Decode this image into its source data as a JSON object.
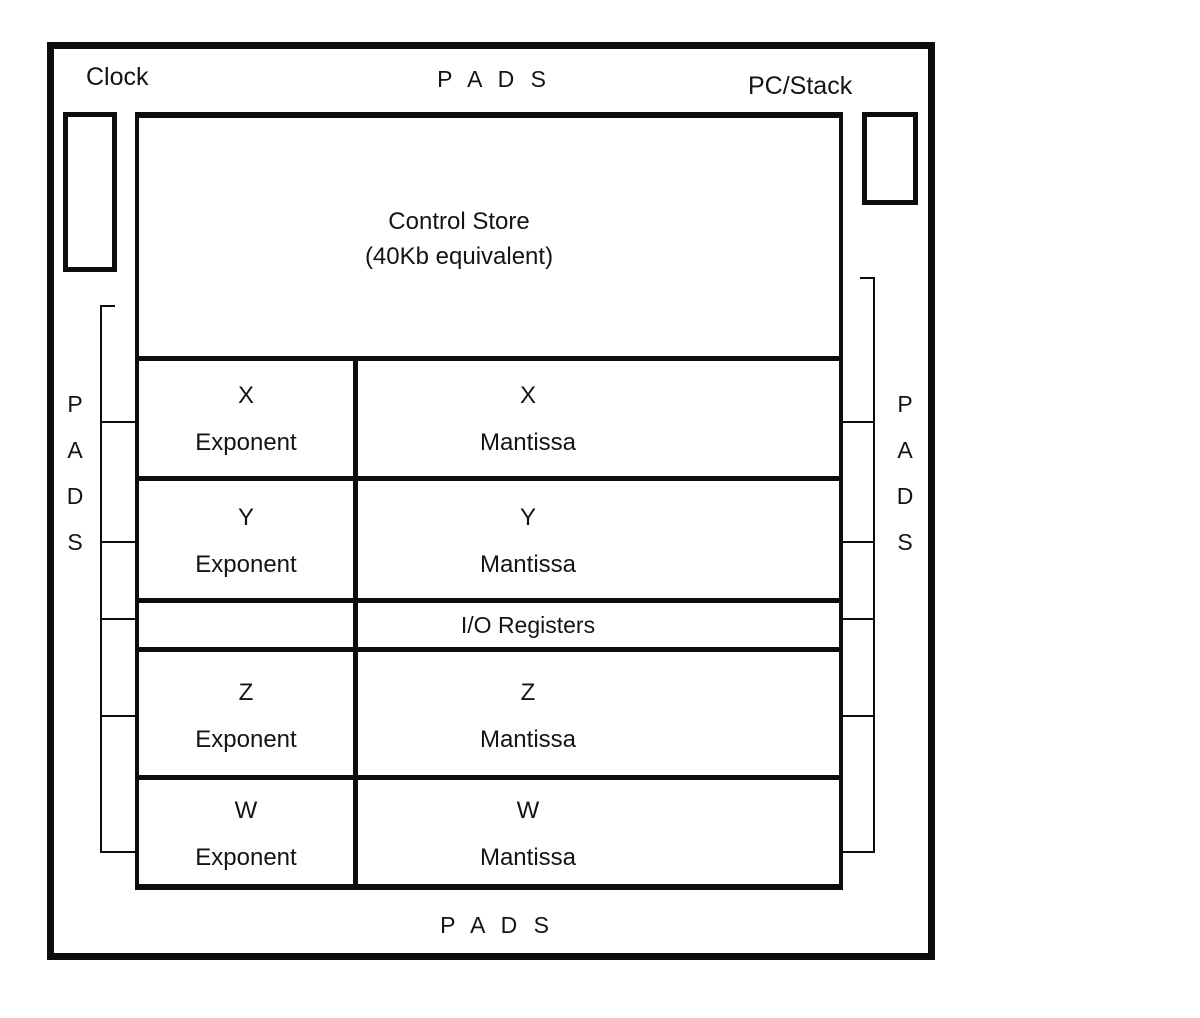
{
  "diagram": {
    "top_labels": {
      "clock": "Clock",
      "pads": "P A D S",
      "pc_stack": "PC/Stack"
    },
    "control_store": {
      "title": "Control Store",
      "subtitle": "(40Kb equivalent)"
    },
    "register_rows": [
      {
        "exp_letter": "X",
        "exp_word": "Exponent",
        "man_letter": "X",
        "man_word": "Mantissa"
      },
      {
        "exp_letter": "Y",
        "exp_word": "Exponent",
        "man_letter": "Y",
        "man_word": "Mantissa"
      },
      {
        "io_label": "I/O Registers"
      },
      {
        "exp_letter": "Z",
        "exp_word": "Exponent",
        "man_letter": "Z",
        "man_word": "Mantissa"
      },
      {
        "exp_letter": "W",
        "exp_word": "Exponent",
        "man_letter": "W",
        "man_word": "Mantissa"
      }
    ],
    "side_labels": {
      "left": [
        "P",
        "A",
        "D",
        "S"
      ],
      "right": [
        "P",
        "A",
        "D",
        "S"
      ]
    },
    "bottom_labels": {
      "pads": "P A D S"
    },
    "colors": {
      "line": "#0d0d0d",
      "text": "#141414",
      "background": "#ffffff"
    }
  }
}
